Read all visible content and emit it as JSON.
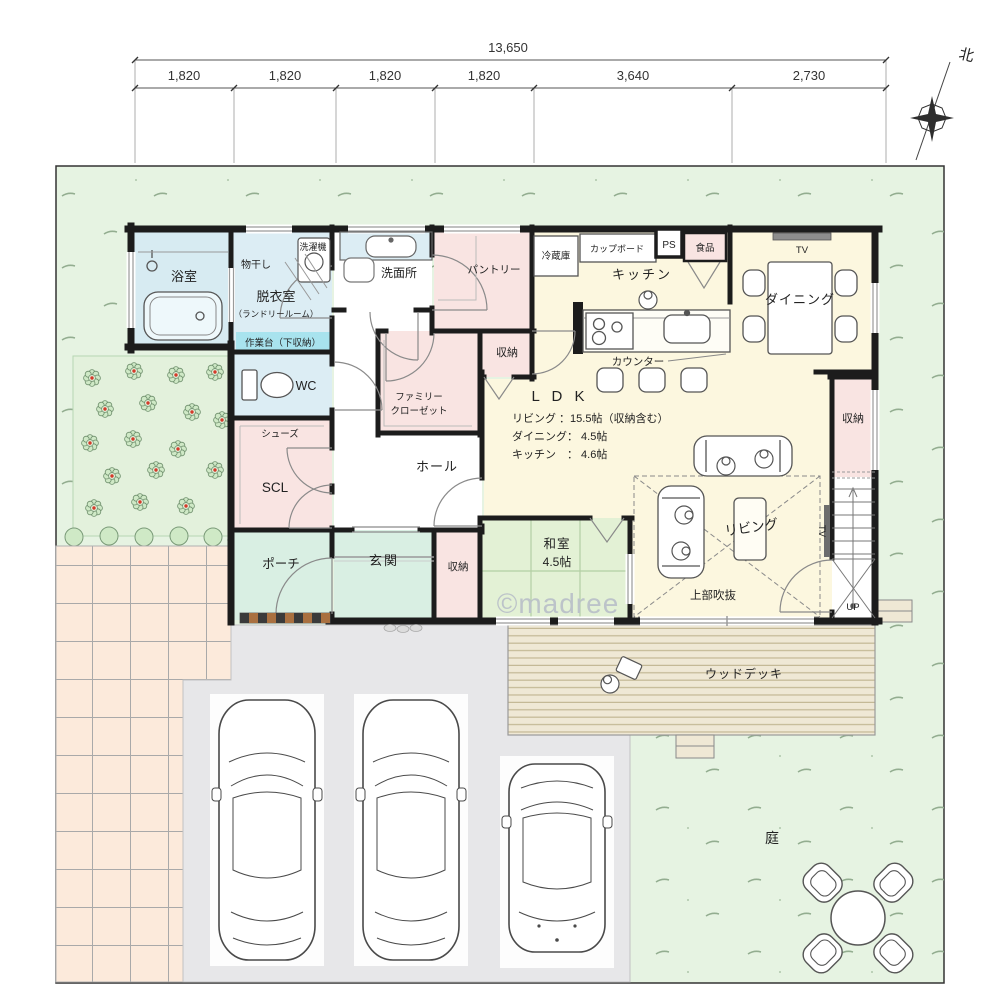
{
  "dimensions": {
    "total": "13,650",
    "segments": [
      "1,820",
      "1,820",
      "1,820",
      "1,820",
      "3,640",
      "2,730"
    ]
  },
  "compass": {
    "north": "北"
  },
  "labels": {
    "bath": "浴室",
    "monohoshi": "物干し",
    "washer": "洗濯機",
    "dressing": "脱衣室",
    "dressing_sub": "（ランドリールーム）",
    "worktop": "作業台（下収納）",
    "wc": "WC",
    "washroom": "洗面所",
    "family_closet_1": "ファミリー",
    "family_closet_2": "クローゼット",
    "pantry": "パントリー",
    "storage": "収納",
    "fridge": "冷蔵庫",
    "cupboard": "カップボード",
    "ps": "PS",
    "food": "食品",
    "kitchen": "キッチン",
    "counter": "カウンター",
    "dining": "ダイニング",
    "tv": "TV",
    "ldk_title": "L D K",
    "ldk_living": "リビング ：15.5帖（収納含む）",
    "ldk_dining": "ダイニング：  4.5帖",
    "ldk_kitchen": "キッチン　：  4.6帖",
    "shoes": "シューズ",
    "scl": "SCL",
    "hall": "ホール",
    "porch": "ポーチ",
    "entrance": "玄関",
    "washitsu": "和室",
    "washitsu_size": "4.5帖",
    "living": "リビング",
    "void": "上部吹抜",
    "up": "UP",
    "wood_deck": "ウッドデッキ",
    "garden": "庭",
    "watermark": "©madree"
  },
  "colors": {
    "wall": "#1c1c1c",
    "lawn": "#e6f3e2",
    "tile": "#fceadb",
    "driveway": "#e7e7e9",
    "deck": "#efe8d5",
    "sanitary_blue": "#dcedf4",
    "worktop_cyan": "#a8e3ee",
    "closet_pink": "#f9e4e2",
    "ldk_yellow": "#fcf7df",
    "tatami_green": "#e3f1d5",
    "entry_mint": "#d9efe3",
    "window_gray": "#9a9a9a"
  }
}
